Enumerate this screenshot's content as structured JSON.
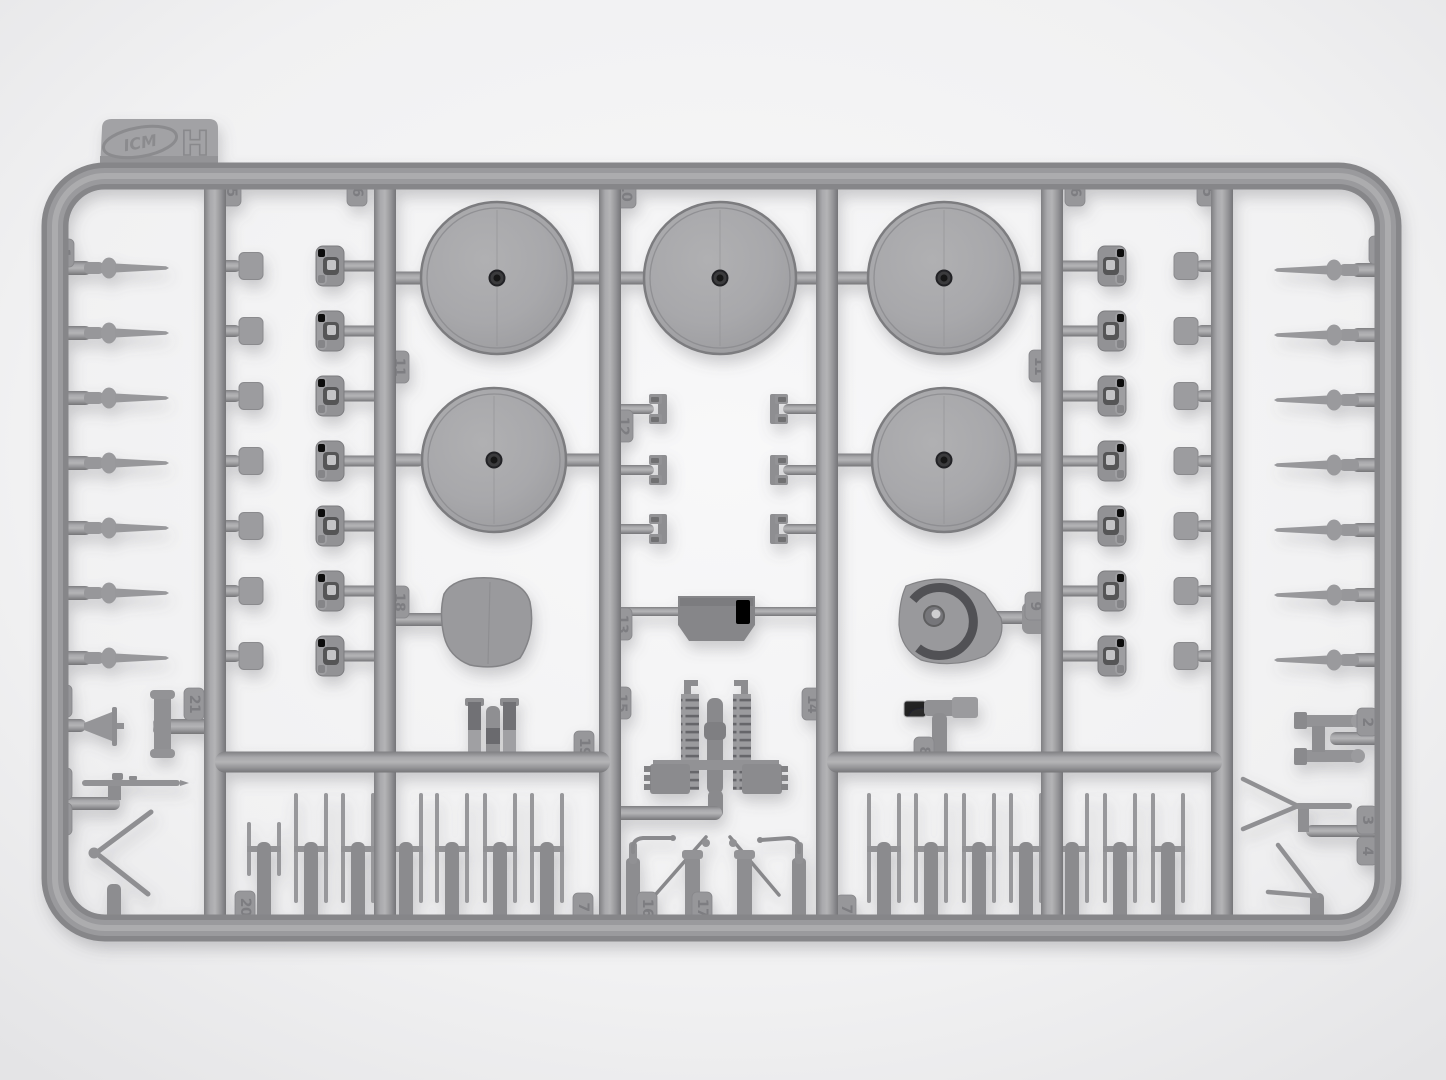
{
  "photo": {
    "subject": "injection-molded model kit sprue, gray plastic on light background",
    "brand_logo": "ICM",
    "sprue_letter": "H",
    "colors": {
      "plastic_mid": "#9a9a9d",
      "plastic_dark": "#7e7e81",
      "plastic_light": "#b2b2b4",
      "disc_face": "#a6a6a9",
      "center_hole": "#2e2e30",
      "background": "#f2f2f3"
    },
    "part_number_tabs": [
      {
        "id": "left-rail-1",
        "label": "1"
      },
      {
        "id": "col2-top-5",
        "label": "5"
      },
      {
        "id": "col2-top-6",
        "label": "6"
      },
      {
        "id": "center-top-10",
        "label": "10"
      },
      {
        "id": "col6-top-6",
        "label": "6"
      },
      {
        "id": "col6-top-5",
        "label": "5"
      },
      {
        "id": "right-rail-1",
        "label": "1"
      },
      {
        "id": "col3-11",
        "label": "11"
      },
      {
        "id": "col6-11",
        "label": "11"
      },
      {
        "id": "col4-12",
        "label": "12"
      },
      {
        "id": "col3-18",
        "label": "18"
      },
      {
        "id": "col4-13",
        "label": "13"
      },
      {
        "id": "col4-15",
        "label": "15"
      },
      {
        "id": "col4-14",
        "label": "14"
      },
      {
        "id": "col5-9",
        "label": "9"
      },
      {
        "id": "col3-19",
        "label": "19"
      },
      {
        "id": "col5-8",
        "label": "8"
      },
      {
        "id": "left-21",
        "label": "21"
      },
      {
        "id": "left-22",
        "label": "22"
      },
      {
        "id": "left-23",
        "label": "23"
      },
      {
        "id": "left-24",
        "label": "24"
      },
      {
        "id": "band-left-20",
        "label": "20"
      },
      {
        "id": "band-left-7",
        "label": "7"
      },
      {
        "id": "center-16",
        "label": "16"
      },
      {
        "id": "center-17",
        "label": "17"
      },
      {
        "id": "band-right-7",
        "label": "7"
      },
      {
        "id": "right-2",
        "label": "2"
      },
      {
        "id": "right-3",
        "label": "3"
      },
      {
        "id": "right-4",
        "label": "4"
      }
    ],
    "parts_inventory": [
      {
        "name": "tapered spike pins on side rails",
        "count": 14
      },
      {
        "name": "large wheel discs",
        "count": 5
      },
      {
        "name": "square pads",
        "count": 14
      },
      {
        "name": "slotted drum hubs",
        "count": 14
      },
      {
        "name": "small clip brackets",
        "count": 6
      },
      {
        "name": "h-shaped pin assemblies (bottom bands)",
        "count": 14
      },
      {
        "name": "gun shield",
        "count": 1
      },
      {
        "name": "mantlet with ring",
        "count": 1
      },
      {
        "name": "radiator-engine block",
        "count": 1
      },
      {
        "name": "antenna v-shapes",
        "count": 2
      }
    ]
  }
}
